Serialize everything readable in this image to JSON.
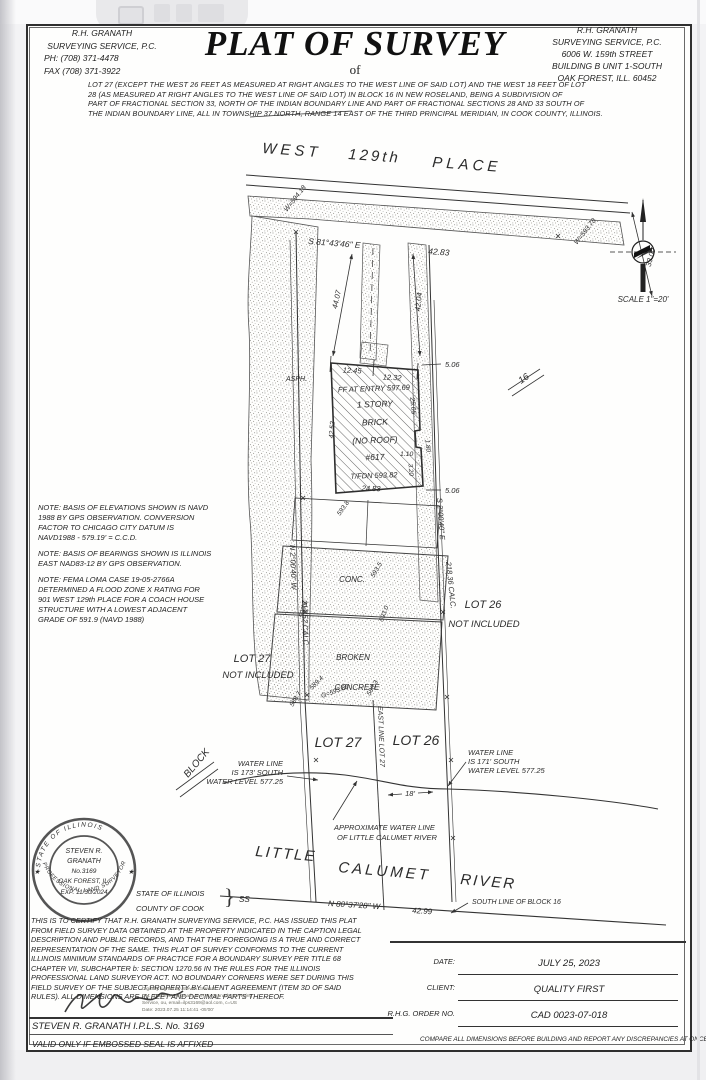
{
  "header": {
    "left": [
      "R.H. GRANATH",
      "SURVEYING SERVICE, P.C.",
      "PH: (708) 371-4478",
      "FAX (708) 371-3922"
    ],
    "title": "PLAT OF SURVEY",
    "subtitle": "of",
    "right": [
      "R.H. GRANATH",
      "SURVEYING SERVICE, P.C.",
      "6006 W. 159th STREET",
      "BUILDING B UNIT 1-SOUTH",
      "OAK FOREST, ILL. 60452"
    ]
  },
  "legal": {
    "lines": [
      "LOT 27 (EXCEPT THE WEST 26 FEET AS MEASURED AT RIGHT ANGLES TO THE WEST LINE OF SAID LOT) AND THE WEST 18 FEET OF LOT",
      "28 (AS MEASURED AT RIGHT ANGLES TO THE WEST LINE OF SAID LOT) IN BLOCK 16 IN NEW ROSELAND, BEING A SUBDIVISION OF",
      "PART OF FRACTIONAL SECTION 33, NORTH OF THE INDIAN BOUNDARY LINE AND PART OF FRACTIONAL SECTIONS 28 AND 33 SOUTH OF",
      "THE INDIAN BOUNDARY LINE, ALL IN TOWNSHIP 37 NORTH, RANGE 14 EAST OF THE THIRD PRINCIPAL MERIDIAN, IN COOK COUNTY, ILLINOIS."
    ]
  },
  "drawing": {
    "street_w": "WEST",
    "street_n": "129th",
    "street_p": "PLACE",
    "top_bearing": "S 81°43'46\" E",
    "top_dist": "42.83",
    "dim33": "33.00",
    "w_left": "W=594.18",
    "w_right": "W=593.78",
    "asph": "ASPH.",
    "dim4407": "44.07",
    "dim4204": "42.04",
    "dim1245": "12.45",
    "dim1232": "12.32",
    "ff": "FF AT ENTRY 597.69",
    "bldg1": "1 STORY",
    "bldg2": "BRICK",
    "bldg3": "(NO ROOF)",
    "bldg4": "#617",
    "tfdn": "T/FDN 593.82",
    "dim2483": "24.83",
    "dim4252": "42.52",
    "dim2505": "25.05",
    "dim110": "1.10",
    "dim180": "1.80",
    "dim320": "3.20",
    "dim506a": "5.06",
    "dim506b": "5.06",
    "flag16": "16",
    "east_bearing": "S 2°00'40\" E",
    "east_dist": "218.36 CALC.",
    "west_bearing": "N 2°00'40\" W",
    "west_dist": "217.52 CALC.",
    "lot26": "LOT 26",
    "lot26_note": "NOT INCLUDED",
    "lot27": "LOT 27",
    "lot27_note": "NOT INCLUDED",
    "conc": "CONC.",
    "broken": "BROKEN",
    "concrete": "CONCRETE",
    "sp5938": "593.8",
    "sp5936": "593.6",
    "sp5935": "593.5",
    "sp5930": "593.0",
    "sp5894": "589.4",
    "spg": "G=593.80",
    "sp5883": "588.3",
    "sp5887": "588.7",
    "east_line": "EAST LINE LOT 27",
    "lot27_big": "LOT 27",
    "lot26_big": "LOT 26",
    "block": "BLOCK",
    "wl_l1": "WATER LINE",
    "wl_l2": "IS 173' SOUTH",
    "wl_l3": "WATER LEVEL 577.25",
    "wr_l1": "WATER LINE",
    "wr_l2": "IS 171' SOUTH",
    "wr_l3": "WATER LEVEL 577.25",
    "dim18": "18'",
    "awl1": "APPROXIMATE WATER LINE",
    "awl2": "OF LITTLE CALUMET RIVER",
    "river1": "LITTLE",
    "river2": "CALUMET",
    "river3": "RIVER",
    "south_bearing": "N 80°37'28\" W",
    "south_dist": "42.99",
    "south_line": "SOUTH LINE OF BLOCK 16",
    "scale": "SCALE 1\"=20'"
  },
  "notes": {
    "n1": [
      "NOTE: BASIS OF ELEVATIONS SHOWN IS NAVD",
      "1988 BY GPS OBSERVATION. CONVERSION",
      "FACTOR TO CHICAGO CITY DATUM IS",
      "NAVD1988 - 579.19' = C.C.D."
    ],
    "n2": [
      "NOTE: BASIS OF BEARINGS SHOWN IS ILLINOIS",
      "EAST NAD83-12 BY GPS OBSERVATION."
    ],
    "n3": [
      "NOTE: FEMA LOMA CASE 19-05-2766A",
      "DETERMINED A FLOOD ZONE X RATING FOR",
      "901 WEST 129th PLACE FOR A COACH HOUSE",
      "STRUCTURE WITH A LOWEST ADJACENT",
      "GRADE OF 591.9 (NAVD 1988)"
    ]
  },
  "seal": {
    "arc_top": "STATE OF ILLINOIS",
    "arc_bottom": "PROFESSIONAL LAND SURVEYOR",
    "l1": "STEVEN R.",
    "l2": "GRANATH",
    "l3": "No.3169",
    "l4": "OAK FOREST, IL.",
    "l5": "EXP. 11/30/2024",
    "star": "★"
  },
  "jurat": {
    "l1": "STATE OF ILLINOIS",
    "l2": "COUNTY OF COOK",
    "ss": "SS",
    "brace": "}"
  },
  "cert": {
    "lines": [
      "THIS IS TO CERTIFY THAT R.H. GRANATH SURVEYING SERVICE, P.C. HAS ISSUED THIS PLAT",
      "FROM FIELD SURVEY DATA OBTAINED AT THE PROPERTY INDICATED IN THE CAPTION LEGAL",
      "DESCRIPTION AND PUBLIC RECORDS, AND THAT THE FOREGOING IS A TRUE AND CORRECT",
      "REPRESENTATION OF THE SAME. THIS PLAT OF SURVEY CONFORMS TO THE CURRENT",
      "ILLINOIS MINIMUM STANDARDS OF PRACTICE FOR A BOUNDARY SURVEY PER TITLE 68",
      "CHAPTER VII, SUBCHAPTER b: SECTION 1270.56 IN THE RULES FOR THE ILLINOIS",
      "PROFESSIONAL LAND SURVEYOR ACT. NO BOUNDARY CORNERS WERE SET DURING THIS",
      "FIELD SURVEY OF THE SUBJECT PROPERTY BY CLIENT AGREEMENT (ITEM 3D OF SAID",
      "RULES). ALL DIMENSIONS ARE IN FEET AND DECIMAL PARTS THEREOF."
    ]
  },
  "digsig": {
    "lines": [
      "Digitally signed by Steven Granath",
      "DN: cn=Steven Granath, o=R.H. Granath Surveying",
      "Service, ou, email=ilps3169@aol.com, c=US",
      "Date: 2023.07.25 11:14:41 -05'00'"
    ]
  },
  "footer": {
    "surveyor": "STEVEN R. GRANATH I.P.L.S. No. 3169",
    "valid": "VALID ONLY IF EMBOSSED SEAL IS AFFIXED",
    "date_label": "DATE:",
    "date_value": "JULY 25, 2023",
    "client_label": "CLIENT:",
    "client_value": "QUALITY FIRST",
    "order_label": "R.H.G. ORDER NO.",
    "order_value": "CAD 0023-07-018",
    "compare": "COMPARE ALL DIMENSIONS BEFORE BUILDING AND REPORT ANY DISCREPANCIES AT ONCE."
  }
}
